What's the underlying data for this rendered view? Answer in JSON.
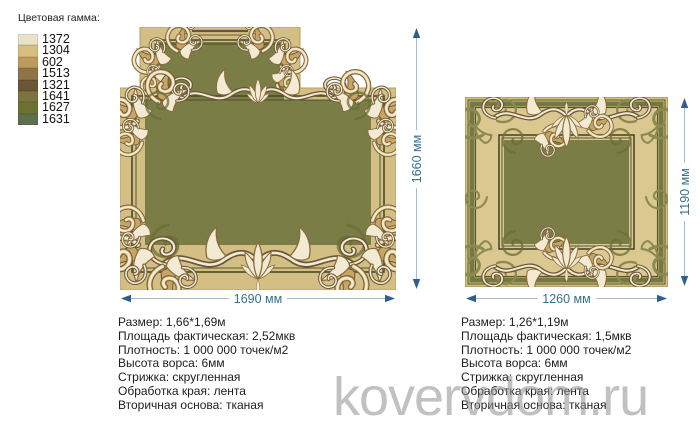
{
  "colors": {
    "tan": "#d3bf83",
    "tanEdge": "#b5a265",
    "green": "#7b7d46",
    "greenBand": "#75783f",
    "darkLine": "#474c28",
    "beige": "#dbc890",
    "cream": "#f2ead2",
    "ornTan": "#c9a565",
    "ornBrown": "#8a6a3c",
    "ornDark": "#6b5737",
    "oliveOrn": "#8a8a52",
    "greenShadow": "#6b6e38",
    "dimLine": "#a9bcc9",
    "dimArrow": "#2d5f8a",
    "dimText": "#35708e",
    "specText": "#1d1d1d",
    "watermark": "#909090"
  },
  "palette": {
    "title": "Цветовая гамма:",
    "swatches": [
      {
        "code": "1372",
        "color": "#e9e2cb"
      },
      {
        "code": "1304",
        "color": "#d7be81"
      },
      {
        "code": "602",
        "color": "#bd9a5e"
      },
      {
        "code": "1513",
        "color": "#8f7448"
      },
      {
        "code": "1321",
        "color": "#6b5738"
      },
      {
        "code": "1641",
        "color": "#7d7340"
      },
      {
        "code": "1627",
        "color": "#6d7233"
      },
      {
        "code": "1631",
        "color": "#5e6f4f"
      }
    ]
  },
  "left_carpet": {
    "width_label": "1690 мм",
    "height_label": "1660 мм",
    "specs": [
      "Размер: 1,66*1,69м",
      "Площадь фактическая: 2,52мкв",
      "Плотность: 1 000 000 точек/м2",
      "Высота ворса: 6мм",
      "Стрижка: скругленная",
      "Обработка края: лента",
      "Вторичная основа: тканая"
    ]
  },
  "right_carpet": {
    "width_label": "1260 мм",
    "height_label": "1190 мм",
    "specs": [
      "Размер: 1,26*1,19м",
      "Площадь фактическая: 1,5мкв",
      "Плотность: 1 000 000 точек/м2",
      "Высота ворса: 6мм",
      "Стрижка: скругленная",
      "Обработка края: лента",
      "Вторичная основа: тканая"
    ]
  },
  "watermark": {
    "text": "kovervdom.ru"
  }
}
